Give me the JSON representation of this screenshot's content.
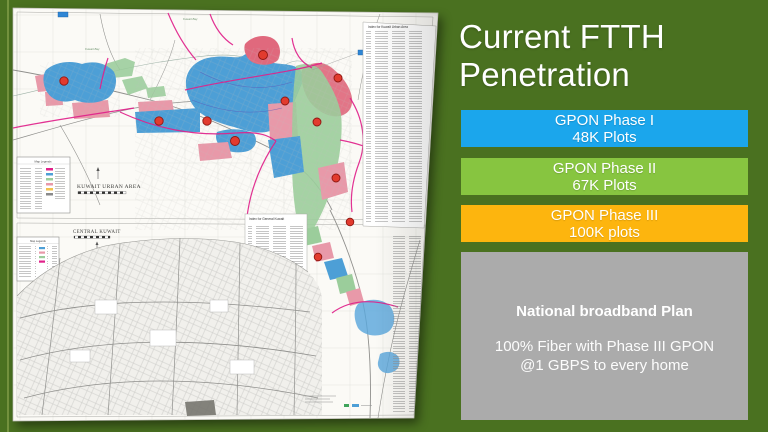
{
  "slide": {
    "background_color": "#4A7120",
    "accent_line_color": "#75943F"
  },
  "title": {
    "line1": "Current FTTH",
    "line2": "Penetration"
  },
  "phases": [
    {
      "label": "GPON Phase I",
      "plots": "48K Plots",
      "color": "#1BA6EC"
    },
    {
      "label": "GPON Phase II",
      "plots": "67K Plots",
      "color": "#87C540"
    },
    {
      "label": "GPON Phase III",
      "plots": "100K plots",
      "color": "#FDB50E"
    }
  ],
  "plan": {
    "heading": "National broadband Plan",
    "line1": "100% Fiber with Phase III GPON",
    "line2": "@1 GBPS to every home",
    "background_color": "#ABABAB"
  },
  "map": {
    "top_panel_title": "KUWAIT URBAN AREA",
    "bottom_panel_title": "CENTRAL KUWAIT",
    "bay_label": "Kuwait Bay",
    "index_top_title": "Index for Kuwait Urban Area",
    "index_bottom_title": "Index for General Kuwait",
    "legend_title": "Map Legends",
    "region_colors": {
      "blue_region": "#4D9FD6",
      "pink_region": "#E899A9",
      "red_region": "#E0697D",
      "green_region": "#9BCD9B",
      "route_line": "#E0218A",
      "marker": "#E23B2E"
    }
  }
}
